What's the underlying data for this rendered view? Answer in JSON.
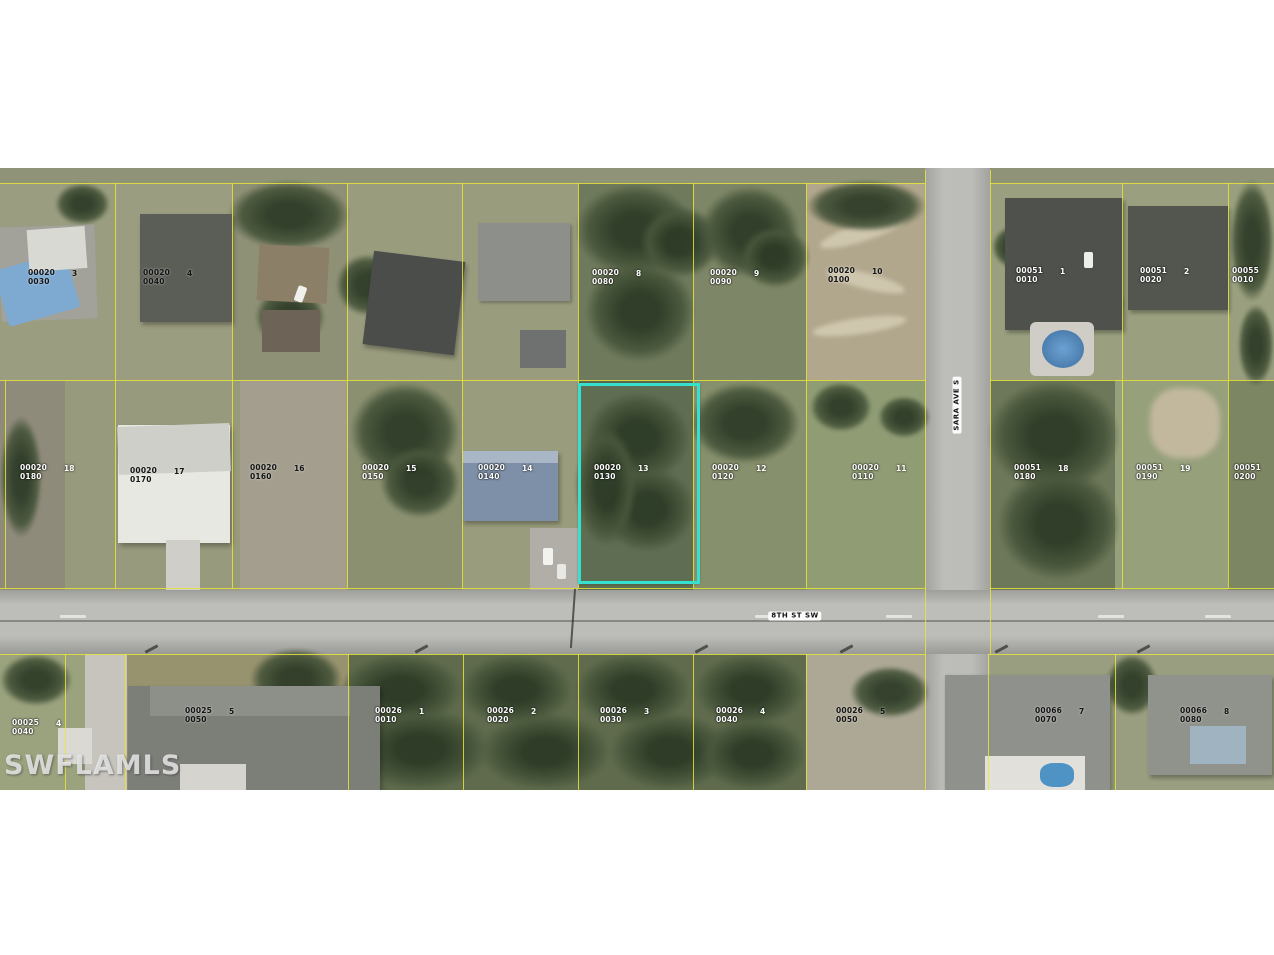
{
  "map": {
    "watermark": "SWFLAMLS",
    "streets": [
      {
        "name": "8TH ST SW",
        "x": 795,
        "y": 616,
        "vertical": false
      },
      {
        "name": "SARA AVE S",
        "x": 957,
        "y": 405,
        "vertical": true
      }
    ],
    "highlight": {
      "lot": "00020",
      "sub": "0130",
      "num": "13",
      "x": 578,
      "y": 383,
      "width": 116,
      "height": 195,
      "color": "#35e0cf"
    },
    "parcel_labels": [
      {
        "lot": "00020",
        "sub": "0030",
        "num": "3",
        "x": 28,
        "y": 268,
        "dark": true
      },
      {
        "lot": "00020",
        "sub": "0040",
        "num": "4",
        "x": 143,
        "y": 268,
        "dark": true
      },
      {
        "lot": "00020",
        "sub": "0080",
        "num": "8",
        "x": 592,
        "y": 268,
        "dark": false
      },
      {
        "lot": "00020",
        "sub": "0090",
        "num": "9",
        "x": 710,
        "y": 268,
        "dark": false
      },
      {
        "lot": "00020",
        "sub": "0100",
        "num": "10",
        "x": 828,
        "y": 266,
        "dark": true
      },
      {
        "lot": "00051",
        "sub": "0010",
        "num": "1",
        "x": 1016,
        "y": 266,
        "dark": false
      },
      {
        "lot": "00051",
        "sub": "0020",
        "num": "2",
        "x": 1140,
        "y": 266,
        "dark": false
      },
      {
        "lot": "00055",
        "sub": "0010",
        "num": "3",
        "x": 1232,
        "y": 266,
        "dark": false
      },
      {
        "lot": "00020",
        "sub": "0180",
        "num": "18",
        "x": 20,
        "y": 463,
        "dark": false
      },
      {
        "lot": "00020",
        "sub": "0170",
        "num": "17",
        "x": 130,
        "y": 466,
        "dark": true
      },
      {
        "lot": "00020",
        "sub": "0160",
        "num": "16",
        "x": 250,
        "y": 463,
        "dark": true
      },
      {
        "lot": "00020",
        "sub": "0150",
        "num": "15",
        "x": 362,
        "y": 463,
        "dark": false
      },
      {
        "lot": "00020",
        "sub": "0140",
        "num": "14",
        "x": 478,
        "y": 463,
        "dark": false
      },
      {
        "lot": "00020",
        "sub": "0130",
        "num": "13",
        "x": 594,
        "y": 463,
        "dark": false
      },
      {
        "lot": "00020",
        "sub": "0120",
        "num": "12",
        "x": 712,
        "y": 463,
        "dark": false
      },
      {
        "lot": "00020",
        "sub": "0110",
        "num": "11",
        "x": 852,
        "y": 463,
        "dark": false
      },
      {
        "lot": "00051",
        "sub": "0180",
        "num": "18",
        "x": 1014,
        "y": 463,
        "dark": false
      },
      {
        "lot": "00051",
        "sub": "0190",
        "num": "19",
        "x": 1136,
        "y": 463,
        "dark": false
      },
      {
        "lot": "00051",
        "sub": "0200",
        "num": "20",
        "x": 1234,
        "y": 463,
        "dark": false
      },
      {
        "lot": "00025",
        "sub": "0040",
        "num": "4",
        "x": 12,
        "y": 718,
        "dark": false
      },
      {
        "lot": "00025",
        "sub": "0050",
        "num": "5",
        "x": 185,
        "y": 706,
        "dark": true
      },
      {
        "lot": "00026",
        "sub": "0010",
        "num": "1",
        "x": 375,
        "y": 706,
        "dark": false
      },
      {
        "lot": "00026",
        "sub": "0020",
        "num": "2",
        "x": 487,
        "y": 706,
        "dark": false
      },
      {
        "lot": "00026",
        "sub": "0030",
        "num": "3",
        "x": 600,
        "y": 706,
        "dark": false
      },
      {
        "lot": "00026",
        "sub": "0040",
        "num": "4",
        "x": 716,
        "y": 706,
        "dark": false
      },
      {
        "lot": "00026",
        "sub": "0050",
        "num": "5",
        "x": 836,
        "y": 706,
        "dark": true
      },
      {
        "lot": "00066",
        "sub": "0070",
        "num": "7",
        "x": 1035,
        "y": 706,
        "dark": true
      },
      {
        "lot": "00066",
        "sub": "0080",
        "num": "8",
        "x": 1180,
        "y": 706,
        "dark": true
      }
    ],
    "parcel_lines": [
      [
        0,
        183,
        925,
        1
      ],
      [
        990,
        183,
        284,
        1
      ],
      [
        0,
        380,
        925,
        1
      ],
      [
        990,
        380,
        284,
        1
      ],
      [
        0,
        588,
        925,
        1
      ],
      [
        990,
        588,
        284,
        1
      ],
      [
        0,
        654,
        925,
        1
      ],
      [
        988,
        654,
        286,
        1
      ],
      [
        5,
        380,
        1,
        208
      ],
      [
        115,
        183,
        1,
        405
      ],
      [
        232,
        183,
        1,
        405
      ],
      [
        347,
        183,
        1,
        405
      ],
      [
        462,
        183,
        1,
        405
      ],
      [
        578,
        183,
        1,
        405
      ],
      [
        693,
        183,
        1,
        405
      ],
      [
        806,
        183,
        1,
        405
      ],
      [
        925,
        170,
        1,
        484
      ],
      [
        990,
        170,
        1,
        484
      ],
      [
        925,
        654,
        1,
        136
      ],
      [
        988,
        654,
        1,
        136
      ],
      [
        1122,
        183,
        1,
        405
      ],
      [
        1228,
        183,
        1,
        405
      ],
      [
        65,
        654,
        1,
        136
      ],
      [
        125,
        654,
        1,
        136
      ],
      [
        348,
        654,
        1,
        136
      ],
      [
        463,
        654,
        1,
        136
      ],
      [
        578,
        654,
        1,
        136
      ],
      [
        693,
        654,
        1,
        136
      ],
      [
        806,
        654,
        1,
        136
      ],
      [
        1115,
        654,
        1,
        136
      ]
    ]
  },
  "colors": {
    "parcel_line": "#e8e438",
    "highlight": "#35e0cf",
    "label_light": "#ffffff",
    "label_dark": "#141414",
    "road": "#bcbcb8"
  }
}
